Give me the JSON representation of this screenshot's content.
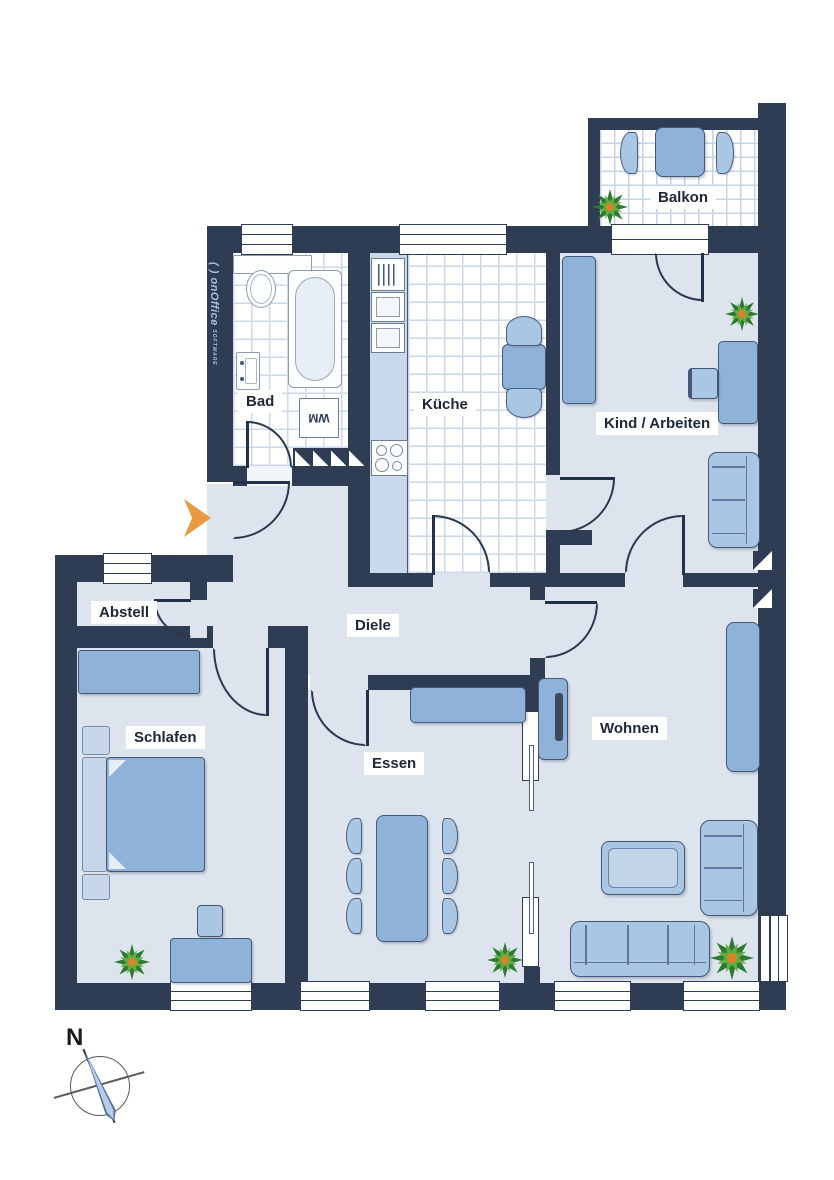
{
  "watermark": {
    "brand": "( ) onOffice",
    "sub": "SOFTWARE"
  },
  "compass": {
    "north_label": "N"
  },
  "rooms": [
    {
      "id": "balkon",
      "label": "Balkon"
    },
    {
      "id": "bad",
      "label": "Bad"
    },
    {
      "id": "kueche",
      "label": "Küche"
    },
    {
      "id": "kind-arbeiten",
      "label": "Kind / Arbeiten"
    },
    {
      "id": "abstell",
      "label": "Abstell"
    },
    {
      "id": "diele",
      "label": "Diele"
    },
    {
      "id": "schlafen",
      "label": "Schlafen"
    },
    {
      "id": "essen",
      "label": "Essen"
    },
    {
      "id": "wohnen",
      "label": "Wohnen"
    }
  ],
  "fixtures": {
    "washing_machine_label": "WM"
  },
  "icons": {
    "entrance": "entrance-arrow",
    "plants": "potted-plant",
    "shaft": "hatched-shaft-marker"
  },
  "colors": {
    "wall": "#2e3d53",
    "floor": "#dde4ee",
    "tile_line": "#ccd9e8",
    "furniture": "#8fb2d8",
    "furniture_light": "#a9c6e2",
    "furniture_pale": "#c7d7ea",
    "plant_dark": "#2e7a35",
    "plant_light": "#63ad3e",
    "plant_center": "#d8832e",
    "entrance_arrow": "#e89a3e",
    "label_text": "#1d2737",
    "watermark_text": "#aebfd6"
  }
}
